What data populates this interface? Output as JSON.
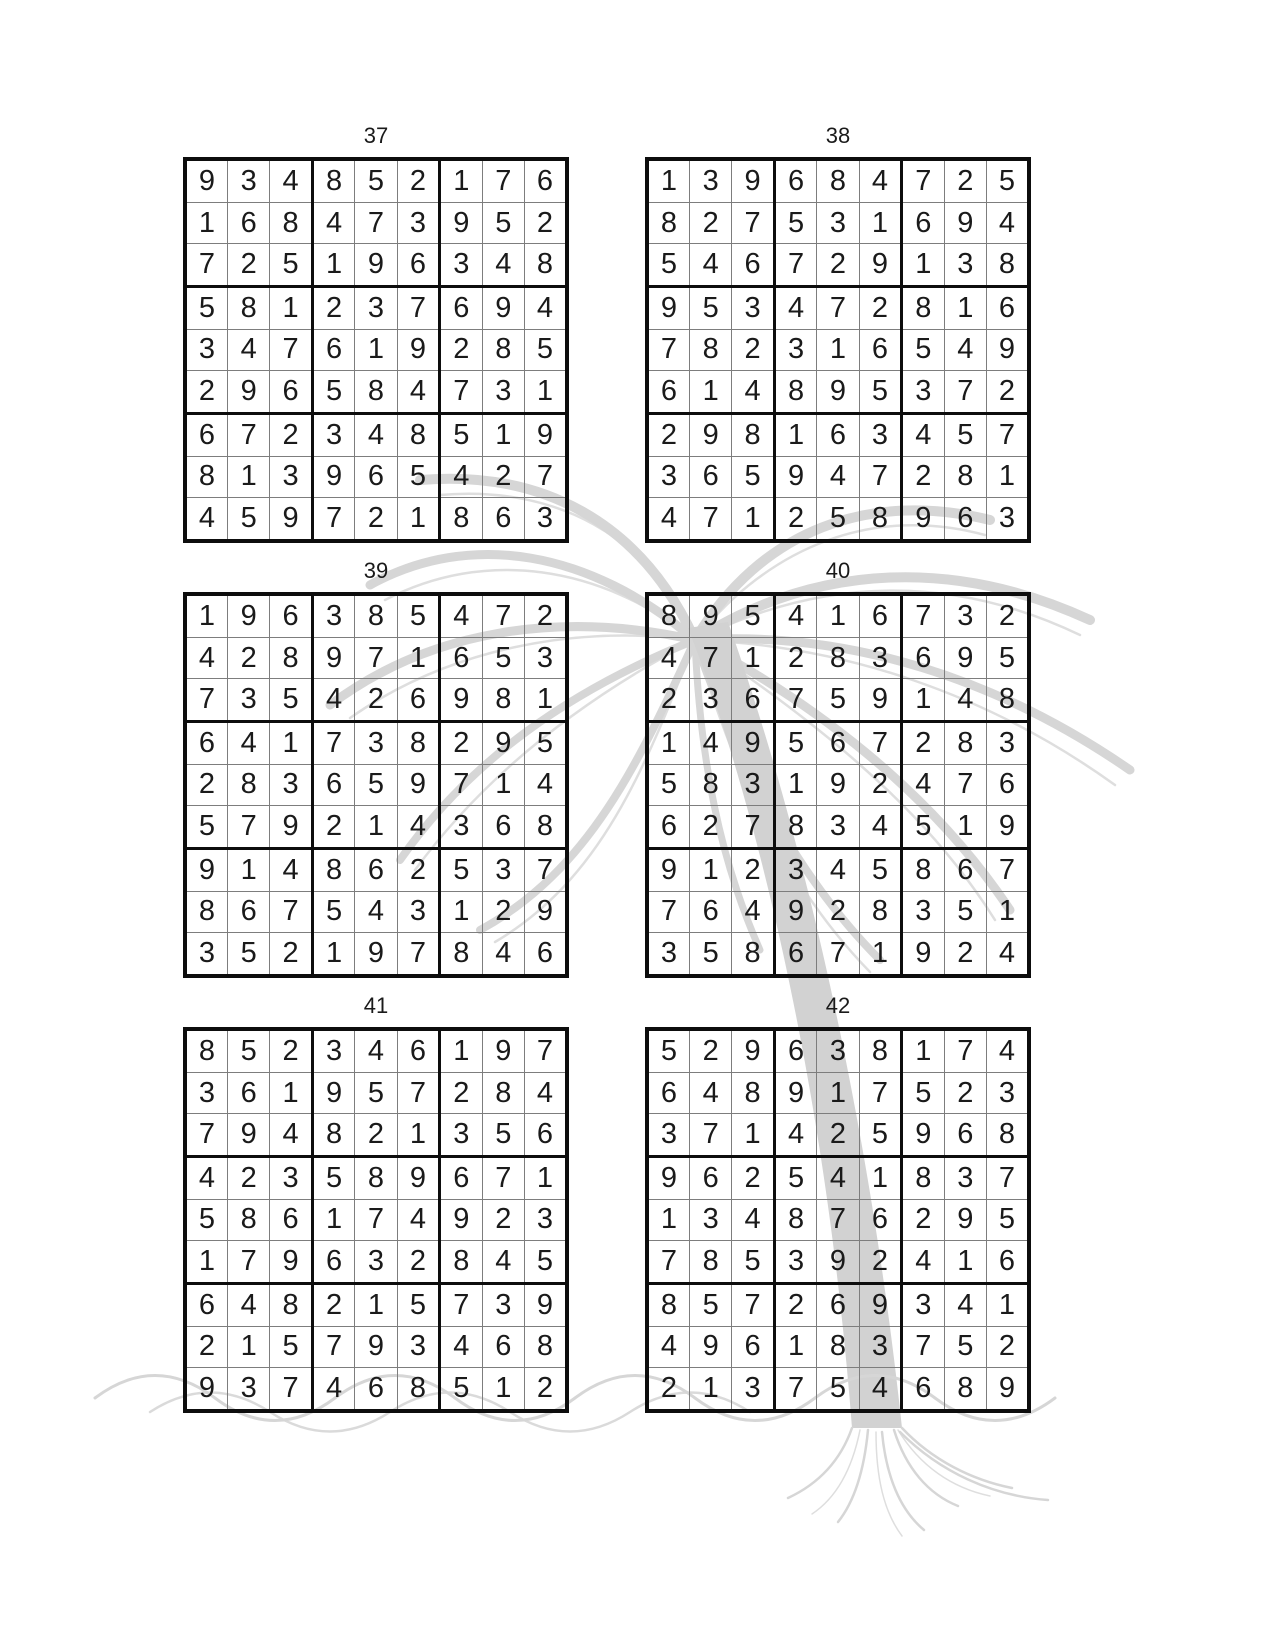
{
  "colors": {
    "digit": "#1a1a1a",
    "grid_line_thin": "#7d7d7d",
    "grid_line_thick": "#0d0d0d",
    "watermark": "#d6d6d6",
    "background": "#ffffff"
  },
  "puzzles": [
    {
      "label": "37",
      "grid": [
        [
          9,
          3,
          4,
          8,
          5,
          2,
          1,
          7,
          6
        ],
        [
          1,
          6,
          8,
          4,
          7,
          3,
          9,
          5,
          2
        ],
        [
          7,
          2,
          5,
          1,
          9,
          6,
          3,
          4,
          8
        ],
        [
          5,
          8,
          1,
          2,
          3,
          7,
          6,
          9,
          4
        ],
        [
          3,
          4,
          7,
          6,
          1,
          9,
          2,
          8,
          5
        ],
        [
          2,
          9,
          6,
          5,
          8,
          4,
          7,
          3,
          1
        ],
        [
          6,
          7,
          2,
          3,
          4,
          8,
          5,
          1,
          9
        ],
        [
          8,
          1,
          3,
          9,
          6,
          5,
          4,
          2,
          7
        ],
        [
          4,
          5,
          9,
          7,
          2,
          1,
          8,
          6,
          3
        ]
      ]
    },
    {
      "label": "38",
      "grid": [
        [
          1,
          3,
          9,
          6,
          8,
          4,
          7,
          2,
          5
        ],
        [
          8,
          2,
          7,
          5,
          3,
          1,
          6,
          9,
          4
        ],
        [
          5,
          4,
          6,
          7,
          2,
          9,
          1,
          3,
          8
        ],
        [
          9,
          5,
          3,
          4,
          7,
          2,
          8,
          1,
          6
        ],
        [
          7,
          8,
          2,
          3,
          1,
          6,
          5,
          4,
          9
        ],
        [
          6,
          1,
          4,
          8,
          9,
          5,
          3,
          7,
          2
        ],
        [
          2,
          9,
          8,
          1,
          6,
          3,
          4,
          5,
          7
        ],
        [
          3,
          6,
          5,
          9,
          4,
          7,
          2,
          8,
          1
        ],
        [
          4,
          7,
          1,
          2,
          5,
          8,
          9,
          6,
          3
        ]
      ]
    },
    {
      "label": "39",
      "grid": [
        [
          1,
          9,
          6,
          3,
          8,
          5,
          4,
          7,
          2
        ],
        [
          4,
          2,
          8,
          9,
          7,
          1,
          6,
          5,
          3
        ],
        [
          7,
          3,
          5,
          4,
          2,
          6,
          9,
          8,
          1
        ],
        [
          6,
          4,
          1,
          7,
          3,
          8,
          2,
          9,
          5
        ],
        [
          2,
          8,
          3,
          6,
          5,
          9,
          7,
          1,
          4
        ],
        [
          5,
          7,
          9,
          2,
          1,
          4,
          3,
          6,
          8
        ],
        [
          9,
          1,
          4,
          8,
          6,
          2,
          5,
          3,
          7
        ],
        [
          8,
          6,
          7,
          5,
          4,
          3,
          1,
          2,
          9
        ],
        [
          3,
          5,
          2,
          1,
          9,
          7,
          8,
          4,
          6
        ]
      ]
    },
    {
      "label": "40",
      "grid": [
        [
          8,
          9,
          5,
          4,
          1,
          6,
          7,
          3,
          2
        ],
        [
          4,
          7,
          1,
          2,
          8,
          3,
          6,
          9,
          5
        ],
        [
          2,
          3,
          6,
          7,
          5,
          9,
          1,
          4,
          8
        ],
        [
          1,
          4,
          9,
          5,
          6,
          7,
          2,
          8,
          3
        ],
        [
          5,
          8,
          3,
          1,
          9,
          2,
          4,
          7,
          6
        ],
        [
          6,
          2,
          7,
          8,
          3,
          4,
          5,
          1,
          9
        ],
        [
          9,
          1,
          2,
          3,
          4,
          5,
          8,
          6,
          7
        ],
        [
          7,
          6,
          4,
          9,
          2,
          8,
          3,
          5,
          1
        ],
        [
          3,
          5,
          8,
          6,
          7,
          1,
          9,
          2,
          4
        ]
      ]
    },
    {
      "label": "41",
      "grid": [
        [
          8,
          5,
          2,
          3,
          4,
          6,
          1,
          9,
          7
        ],
        [
          3,
          6,
          1,
          9,
          5,
          7,
          2,
          8,
          4
        ],
        [
          7,
          9,
          4,
          8,
          2,
          1,
          3,
          5,
          6
        ],
        [
          4,
          2,
          3,
          5,
          8,
          9,
          6,
          7,
          1
        ],
        [
          5,
          8,
          6,
          1,
          7,
          4,
          9,
          2,
          3
        ],
        [
          1,
          7,
          9,
          6,
          3,
          2,
          8,
          4,
          5
        ],
        [
          6,
          4,
          8,
          2,
          1,
          5,
          7,
          3,
          9
        ],
        [
          2,
          1,
          5,
          7,
          9,
          3,
          4,
          6,
          8
        ],
        [
          9,
          3,
          7,
          4,
          6,
          8,
          5,
          1,
          2
        ]
      ]
    },
    {
      "label": "42",
      "grid": [
        [
          5,
          2,
          9,
          6,
          3,
          8,
          1,
          7,
          4
        ],
        [
          6,
          4,
          8,
          9,
          1,
          7,
          5,
          2,
          3
        ],
        [
          3,
          7,
          1,
          4,
          2,
          5,
          9,
          6,
          8
        ],
        [
          9,
          6,
          2,
          5,
          4,
          1,
          8,
          3,
          7
        ],
        [
          1,
          3,
          4,
          8,
          7,
          6,
          2,
          9,
          5
        ],
        [
          7,
          8,
          5,
          3,
          9,
          2,
          4,
          1,
          6
        ],
        [
          8,
          5,
          7,
          2,
          6,
          9,
          3,
          4,
          1
        ],
        [
          4,
          9,
          6,
          1,
          8,
          3,
          7,
          5,
          2
        ],
        [
          2,
          1,
          3,
          7,
          5,
          4,
          6,
          8,
          9
        ]
      ]
    }
  ]
}
